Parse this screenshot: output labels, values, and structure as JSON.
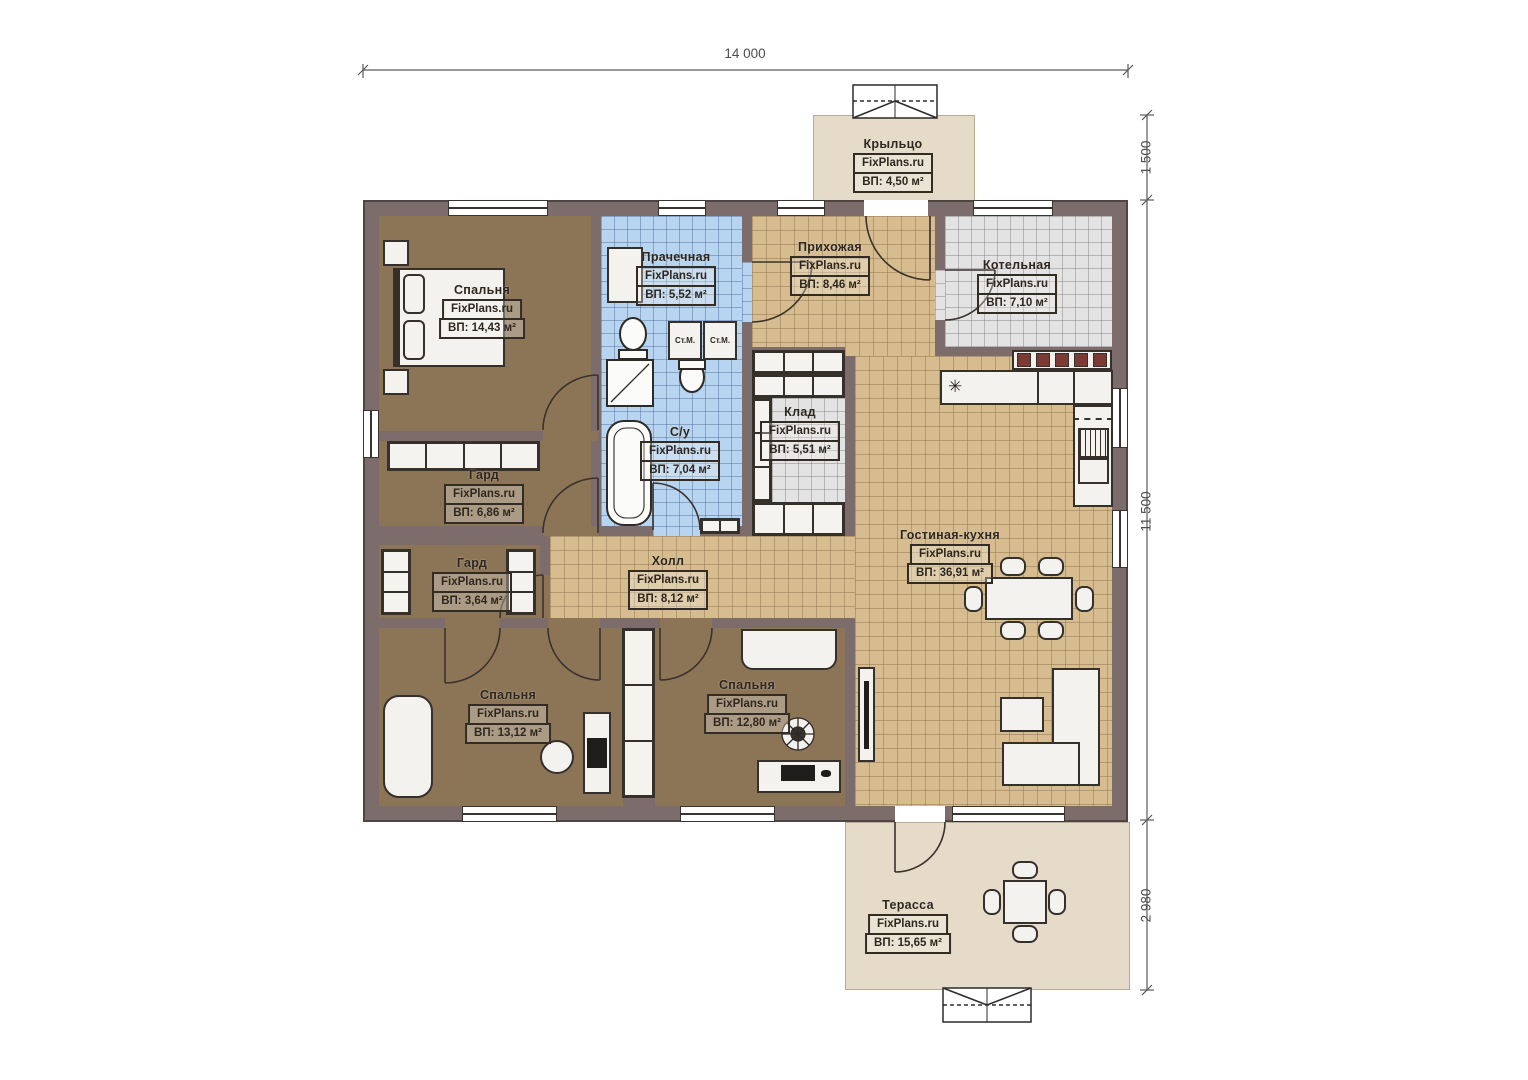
{
  "watermark": "FixPlans.ru",
  "dimensions": {
    "width_total": "14 000",
    "porch_depth": "1 500",
    "house_depth": "11 500",
    "terrace_depth": "2 980"
  },
  "rooms": {
    "porch": {
      "name": "Крыльцо",
      "area": "ВП: 4,50 м²"
    },
    "bedroom1": {
      "name": "Спальня",
      "area": "ВП: 14,43 м²"
    },
    "laundry": {
      "name": "Прачечная",
      "area": "ВП: 5,52 м²"
    },
    "entry_hall": {
      "name": "Прихожая",
      "area": "ВП: 8,46 м²"
    },
    "boiler_room": {
      "name": "Котельная",
      "area": "ВП: 7,10 м²"
    },
    "wardrobe1": {
      "name": "Гард",
      "area": "ВП: 6,86 м²"
    },
    "bathroom": {
      "name": "С/у",
      "area": "ВП: 7,04 м²"
    },
    "storage": {
      "name": "Клад",
      "area": "ВП: 5,51 м²"
    },
    "living_kitchen": {
      "name": "Гостиная-кухня",
      "area": "ВП: 36,91 м²"
    },
    "wardrobe2": {
      "name": "Гард",
      "area": "ВП: 3,64 м²"
    },
    "hall": {
      "name": "Холл",
      "area": "ВП: 8,12 м²"
    },
    "bedroom2": {
      "name": "Спальня",
      "area": "ВП: 13,12 м²"
    },
    "bedroom3": {
      "name": "Спальня",
      "area": "ВП: 12,80 м²"
    },
    "terrace": {
      "name": "Терасса",
      "area": "ВП: 15,65 м²"
    }
  },
  "appliances": {
    "washer_label": "Ст.М.",
    "freezer_symbol": "✳"
  },
  "colors": {
    "wall": "#7d6c6c",
    "bedroom_floor": "#8c7456",
    "tile_tan": "#d6bc8f",
    "tile_blue": "#b7d4f1",
    "tile_gray": "#e3e3e3",
    "deck": "#e6dbc8"
  }
}
